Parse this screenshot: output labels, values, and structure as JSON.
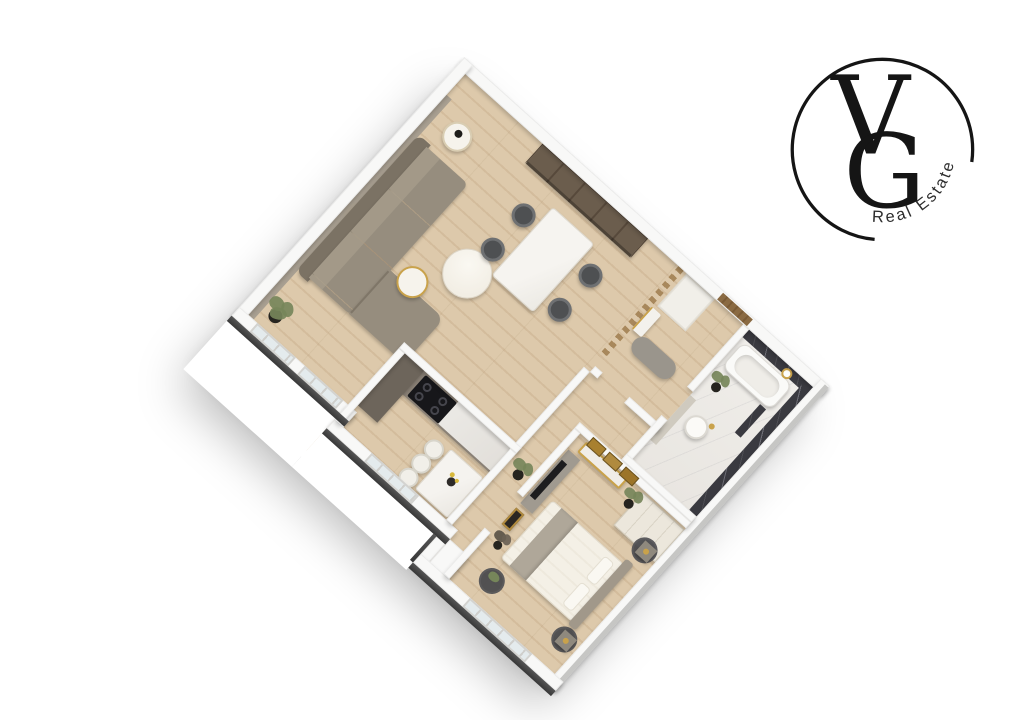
{
  "page": {
    "width": 1027,
    "height": 720,
    "background": "#ffffff"
  },
  "logo": {
    "monogram": {
      "letter_v": "V",
      "letter_g": "G"
    },
    "tagline": "Real Estate",
    "ink_color": "#151515",
    "tagline_color": "#2d2d2d"
  },
  "floorplan": {
    "type": "3d-top-down-apartment-render",
    "rotation_deg": 42,
    "colors": {
      "wood_floor": "#d8c2a4",
      "wall_top": "#f8f8f7",
      "exterior_charcoal": "#3f3f3f",
      "exterior_light": "#c6c6c4",
      "accent_wall": "#a89f91",
      "sofa_body": "#948b7c",
      "sofa_back": "#7b7264",
      "dark_wood_shelf": "#6b5d4d",
      "marble_white": "#f2f0ec",
      "marble_dark": "#3a3a40",
      "kitchen_counter": "#8a8176",
      "kitchen_cabinet": "#6d655b",
      "cooktop": "#17171a",
      "gold_accent": "#c9a24b",
      "cream_wardrobe": "#ece7dc",
      "bed_linen": "#f4f0e6",
      "throw_blanket": "#afa799",
      "rug_charcoal": "#47474b",
      "plant_green": "#76865a",
      "window_glass": "#e4ebed",
      "door_wood": "#8a6a42"
    },
    "rooms": [
      {
        "name": "living-room",
        "furniture": [
          "corner-sofa",
          "coffee-table-large",
          "coffee-table-small",
          "side-table",
          "corner-plant",
          "wall-sconce-upper",
          "wall-sconce-lower",
          "accent-wall",
          "shelving-unit",
          "window-left",
          "window-right"
        ]
      },
      {
        "name": "dining-area",
        "furniture": [
          "dining-table",
          "dining-chair-nw",
          "dining-chair-sw",
          "dining-chair-ne",
          "dining-chair-se"
        ]
      },
      {
        "name": "entry",
        "furniture": [
          "entry-door",
          "slat-divider",
          "bench-ottoman",
          "console-table",
          "closet"
        ]
      },
      {
        "name": "kitchen",
        "furniture": [
          "counter-run",
          "tall-cabinet",
          "cooktop",
          "island-bar",
          "bar-stool-1",
          "bar-stool-2",
          "bar-stool-3",
          "flower-vase",
          "window"
        ]
      },
      {
        "name": "bathroom",
        "furniture": [
          "marble-wall-north",
          "marble-wall-east",
          "bathtub",
          "shower-fixture",
          "marble-partition",
          "round-basin",
          "vanity-ledge",
          "floor-plant",
          "door-opening"
        ]
      },
      {
        "name": "bedroom",
        "furniture": [
          "double-bed",
          "headboard",
          "pillow-top",
          "pillow-bottom",
          "throw-blanket",
          "nightstand-north",
          "nightstand-south",
          "round-rug-north",
          "round-rug-south",
          "round-rug-foot",
          "tv-sideboard",
          "tv",
          "leaning-art",
          "dried-plant",
          "wardrobe",
          "console-table",
          "wall-art-1",
          "wall-art-2",
          "wall-art-3",
          "plant-stand",
          "window"
        ]
      },
      {
        "name": "hallway",
        "furniture": [
          "floor-plant"
        ]
      }
    ]
  }
}
